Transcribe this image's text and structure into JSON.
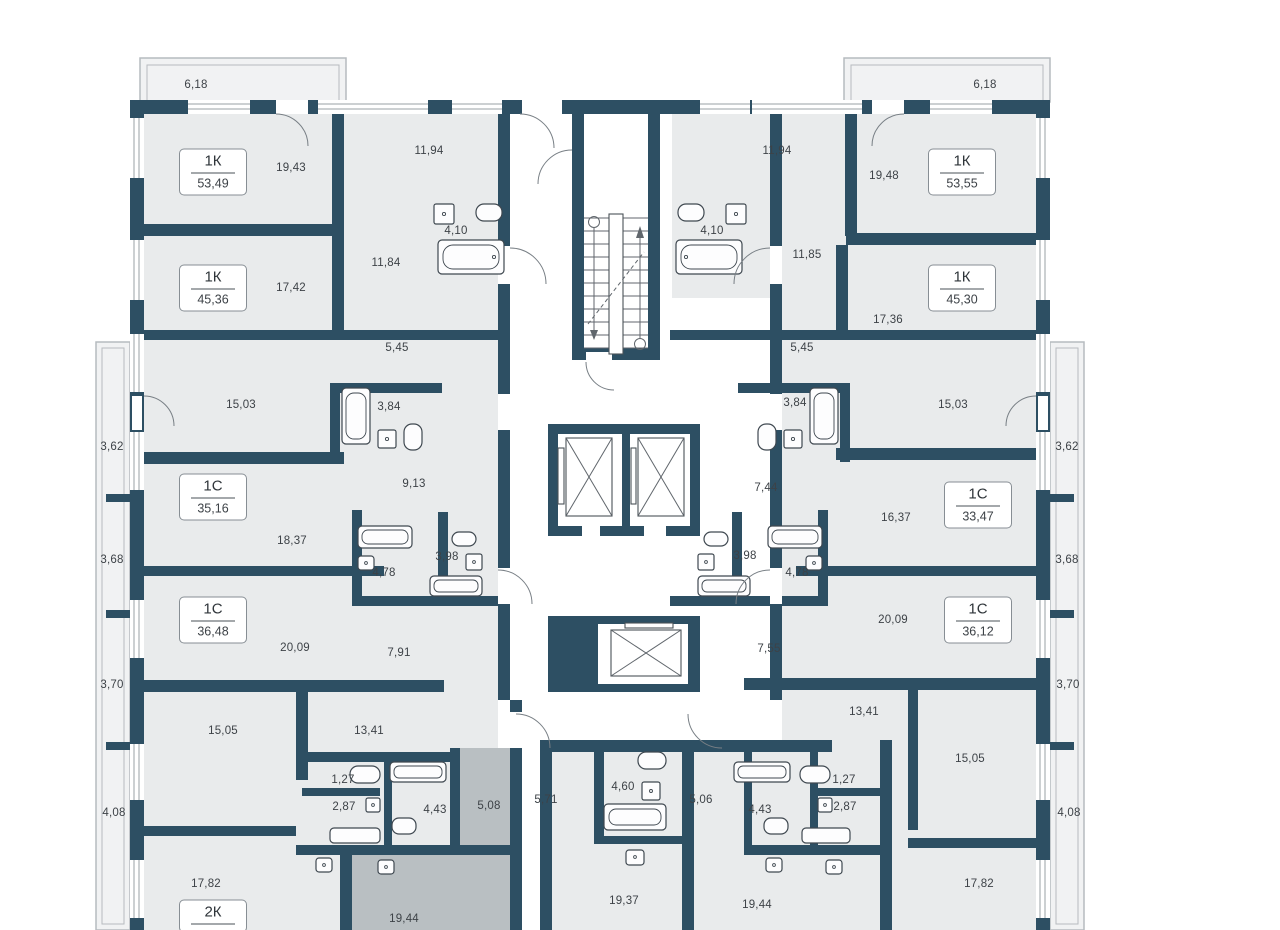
{
  "plan_title": "Floor plan",
  "colors": {
    "wall": "#2d4f63",
    "room": "#e9ebec",
    "highlight": "#b9bfc2"
  },
  "apartments": [
    {
      "type": "1К",
      "area": "53,49",
      "x": 213,
      "y": 172
    },
    {
      "type": "1К",
      "area": "45,36",
      "x": 213,
      "y": 288
    },
    {
      "type": "1С",
      "area": "35,16",
      "x": 213,
      "y": 497
    },
    {
      "type": "1С",
      "area": "36,48",
      "x": 213,
      "y": 620
    },
    {
      "type": "2К",
      "area": "",
      "x": 213,
      "y": 916
    },
    {
      "type": "1К",
      "area": "53,55",
      "x": 962,
      "y": 172
    },
    {
      "type": "1К",
      "area": "45,30",
      "x": 962,
      "y": 288
    },
    {
      "type": "1С",
      "area": "33,47",
      "x": 978,
      "y": 505
    },
    {
      "type": "1С",
      "area": "36,12",
      "x": 978,
      "y": 620
    }
  ],
  "labels": [
    {
      "text": "6,18",
      "x": 196,
      "y": 85
    },
    {
      "text": "19,43",
      "x": 291,
      "y": 168
    },
    {
      "text": "11,94",
      "x": 429,
      "y": 151
    },
    {
      "text": "4,10",
      "x": 456,
      "y": 231
    },
    {
      "text": "11,84",
      "x": 386,
      "y": 263
    },
    {
      "text": "17,42",
      "x": 291,
      "y": 288
    },
    {
      "text": "5,45",
      "x": 397,
      "y": 348
    },
    {
      "text": "15,03",
      "x": 241,
      "y": 405
    },
    {
      "text": "3,84",
      "x": 389,
      "y": 407
    },
    {
      "text": "3,62",
      "x": 112,
      "y": 447
    },
    {
      "text": "18,37",
      "x": 292,
      "y": 541
    },
    {
      "text": "9,13",
      "x": 414,
      "y": 484
    },
    {
      "text": "3,68",
      "x": 112,
      "y": 560
    },
    {
      "text": "3,98",
      "x": 447,
      "y": 557
    },
    {
      "text": "4,78",
      "x": 384,
      "y": 573
    },
    {
      "text": "20,09",
      "x": 295,
      "y": 648
    },
    {
      "text": "7,91",
      "x": 399,
      "y": 653
    },
    {
      "text": "3,70",
      "x": 112,
      "y": 685
    },
    {
      "text": "15,05",
      "x": 223,
      "y": 731
    },
    {
      "text": "13,41",
      "x": 369,
      "y": 731
    },
    {
      "text": "1,27",
      "x": 343,
      "y": 780
    },
    {
      "text": "2,87",
      "x": 344,
      "y": 807
    },
    {
      "text": "4,43",
      "x": 435,
      "y": 810
    },
    {
      "text": "5,08",
      "x": 489,
      "y": 806
    },
    {
      "text": "4,08",
      "x": 114,
      "y": 813
    },
    {
      "text": "17,82",
      "x": 206,
      "y": 884
    },
    {
      "text": "19,44",
      "x": 404,
      "y": 919
    },
    {
      "text": "5,71",
      "x": 546,
      "y": 800
    },
    {
      "text": "4,60",
      "x": 623,
      "y": 787
    },
    {
      "text": "19,37",
      "x": 624,
      "y": 901
    },
    {
      "text": "6,18",
      "x": 985,
      "y": 85
    },
    {
      "text": "11,94",
      "x": 777,
      "y": 151
    },
    {
      "text": "19,48",
      "x": 884,
      "y": 176
    },
    {
      "text": "4,10",
      "x": 712,
      "y": 231
    },
    {
      "text": "11,85",
      "x": 807,
      "y": 255
    },
    {
      "text": "17,36",
      "x": 888,
      "y": 320
    },
    {
      "text": "5,45",
      "x": 802,
      "y": 348
    },
    {
      "text": "3,84",
      "x": 795,
      "y": 403
    },
    {
      "text": "15,03",
      "x": 953,
      "y": 405
    },
    {
      "text": "3,62",
      "x": 1067,
      "y": 447
    },
    {
      "text": "7,44",
      "x": 766,
      "y": 488
    },
    {
      "text": "16,37",
      "x": 896,
      "y": 518
    },
    {
      "text": "3,68",
      "x": 1067,
      "y": 560
    },
    {
      "text": "3,98",
      "x": 745,
      "y": 556
    },
    {
      "text": "4,78",
      "x": 797,
      "y": 573
    },
    {
      "text": "20,09",
      "x": 893,
      "y": 620
    },
    {
      "text": "7,55",
      "x": 769,
      "y": 649
    },
    {
      "text": "3,70",
      "x": 1068,
      "y": 685
    },
    {
      "text": "13,41",
      "x": 864,
      "y": 712
    },
    {
      "text": "15,05",
      "x": 970,
      "y": 759
    },
    {
      "text": "1,27",
      "x": 844,
      "y": 780
    },
    {
      "text": "2,87",
      "x": 845,
      "y": 807
    },
    {
      "text": "4,43",
      "x": 760,
      "y": 810
    },
    {
      "text": "5,06",
      "x": 701,
      "y": 800
    },
    {
      "text": "4,08",
      "x": 1069,
      "y": 813
    },
    {
      "text": "17,82",
      "x": 979,
      "y": 884
    },
    {
      "text": "19,44",
      "x": 757,
      "y": 905
    }
  ]
}
